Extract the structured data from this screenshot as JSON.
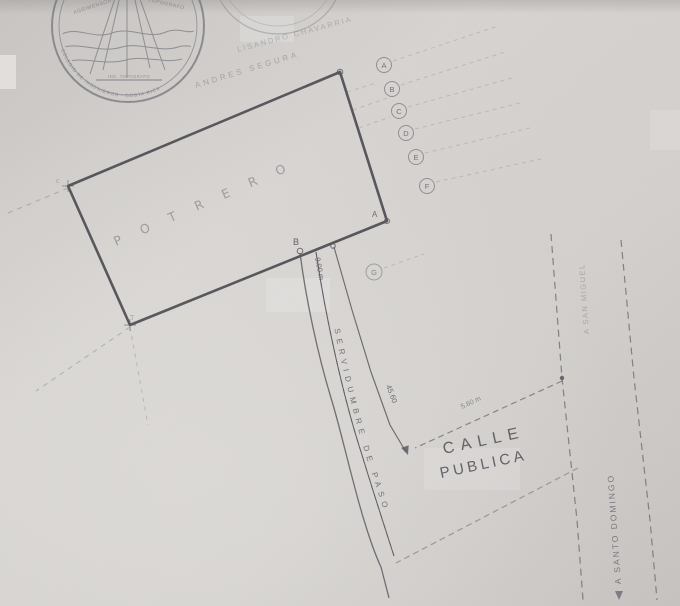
{
  "colors": {
    "paper": "#d5d2cf",
    "ink": "#46464d",
    "mid_ink": "#5c5c64",
    "faint_ink": "#7e7e86"
  },
  "seal_surveyor": {
    "arc_top_left": "AGRIMENSOR",
    "arc_top_right": "TOPOGRAFO",
    "center_band": "ING. TOPOGRAFO",
    "arc_bottom": "COLEGIO DE INGENIEROS · COSTA RICA"
  },
  "neighbor_labels": {
    "upper": "LISANDRO CHAVARRIA",
    "lower": "ANDRES SEGURA"
  },
  "parcel": {
    "land_use": "POTRERO",
    "vertex_a": "A",
    "vertex_b": "B",
    "corner_top_left": "c",
    "corner_bottom_left": "T"
  },
  "boundary_markers": {
    "letters": [
      "A",
      "B",
      "C",
      "D",
      "E",
      "F"
    ],
    "extra": "G"
  },
  "dimensions": {
    "access_opening": "9.00 m",
    "access_length": "45.60",
    "road_width": "5.60 m"
  },
  "roads": {
    "public_road_line1": "CALLE",
    "public_road_line2": "PUBLICA",
    "easement_label": "SERVIDUMBRE DE PASO",
    "destination_south": "A SANTO DOMINGO",
    "destination_north": "A SAN MIGUEL"
  }
}
